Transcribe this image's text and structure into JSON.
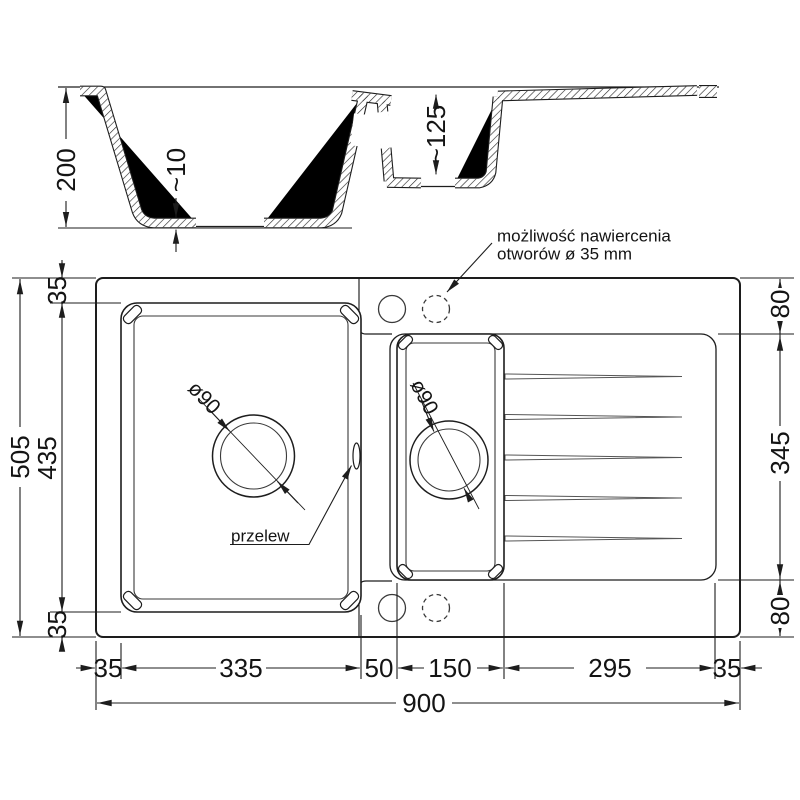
{
  "section": {
    "depth_total": "200",
    "bottom_thickness": "~10",
    "small_bowl_depth": "~125"
  },
  "plan": {
    "left": {
      "total": "505",
      "top": "35",
      "middle": "435",
      "bottom": "35"
    },
    "right": {
      "top": "80",
      "middle": "345",
      "bottom": "80"
    },
    "bottom": {
      "m1": "35",
      "m2": "335",
      "m3": "50",
      "m4": "150",
      "m5": "295",
      "m6": "35",
      "total": "900"
    },
    "drains": {
      "main": "ø90",
      "small": "ø90"
    }
  },
  "annotations": {
    "holes_line1": "możliwość nawiercenia",
    "holes_line2": "otworów ø 35 mm",
    "overflow": "przelew"
  },
  "colors": {
    "line": "#1d1d1d",
    "background": "#ffffff"
  }
}
